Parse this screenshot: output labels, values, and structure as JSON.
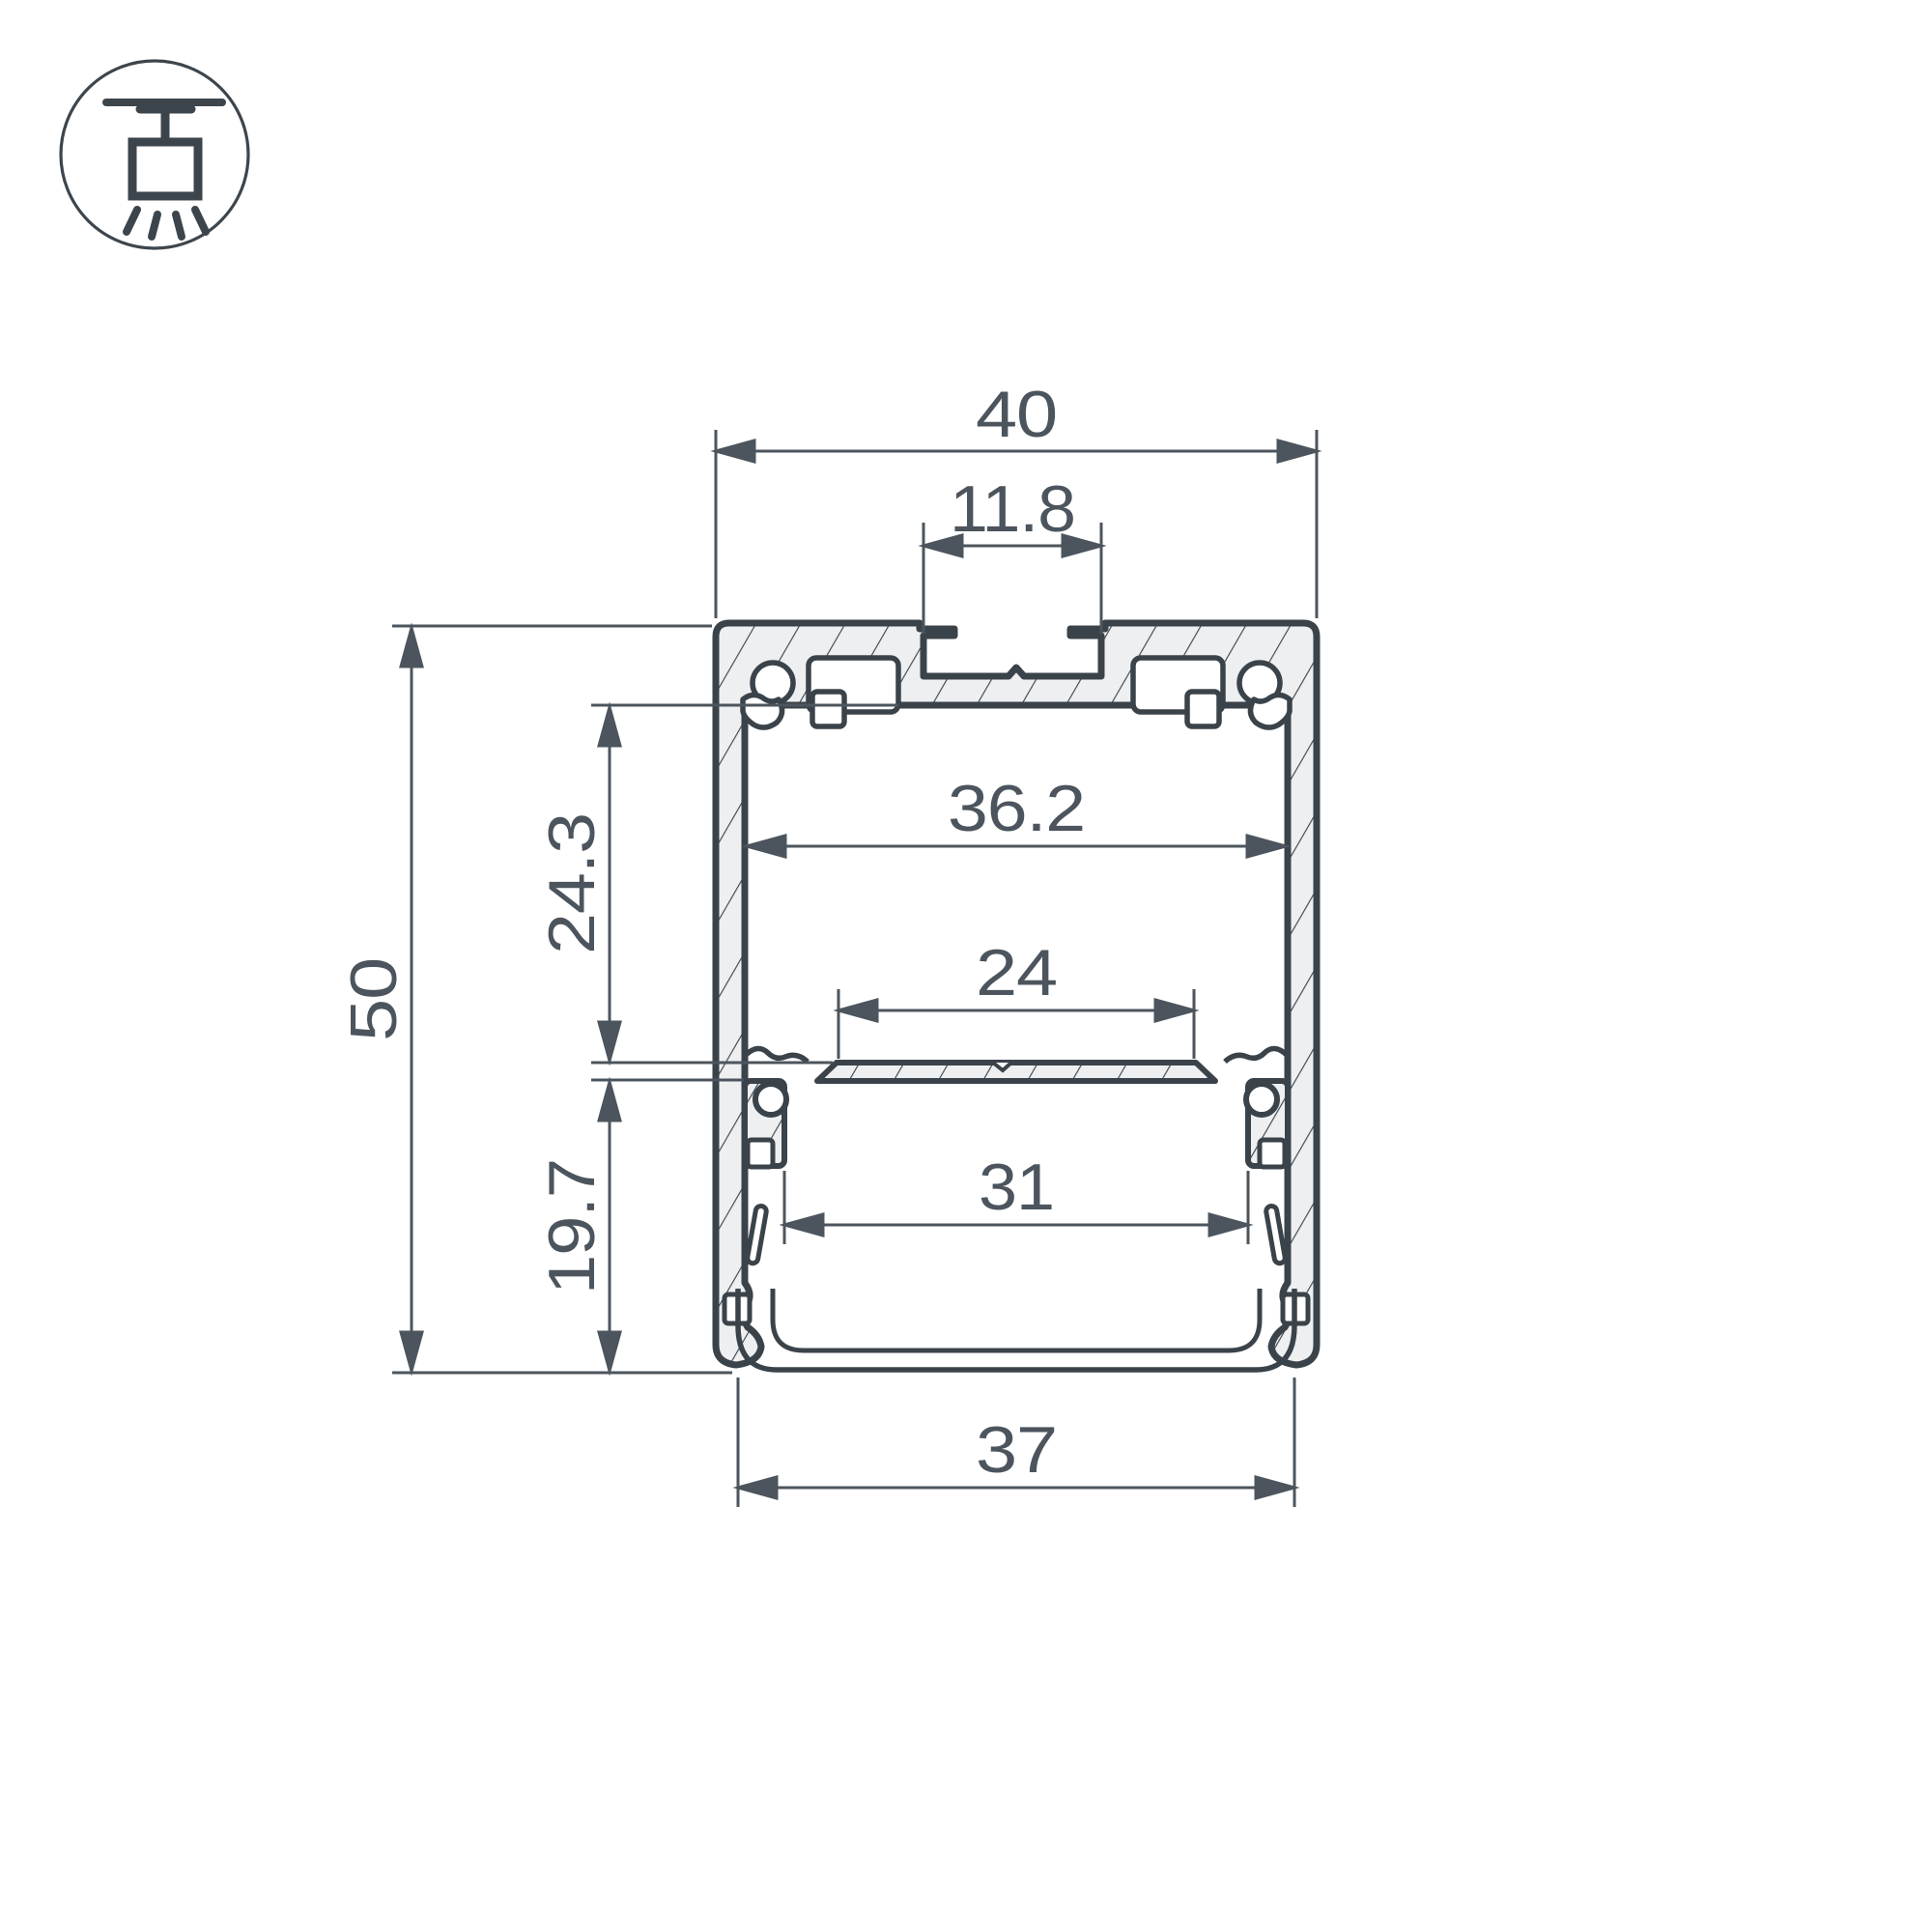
{
  "drawing": {
    "title": "LED profile cross-section dimension drawing",
    "icon": "suspended-mount-icon",
    "dimensions": {
      "outer_width": "40",
      "slot_width": "11.8",
      "inner_width": "36.2",
      "plate_flat_width": "24",
      "board_shelf_width": "31",
      "diffuser_width": "37",
      "outer_height": "50",
      "upper_chamber_height": "24.3",
      "lower_chamber_height": "19.7"
    },
    "colors": {
      "outline": "#3b434a",
      "dimension": "#4c555d",
      "hatch_fill": "#edeff1",
      "background": "#ffffff"
    }
  }
}
